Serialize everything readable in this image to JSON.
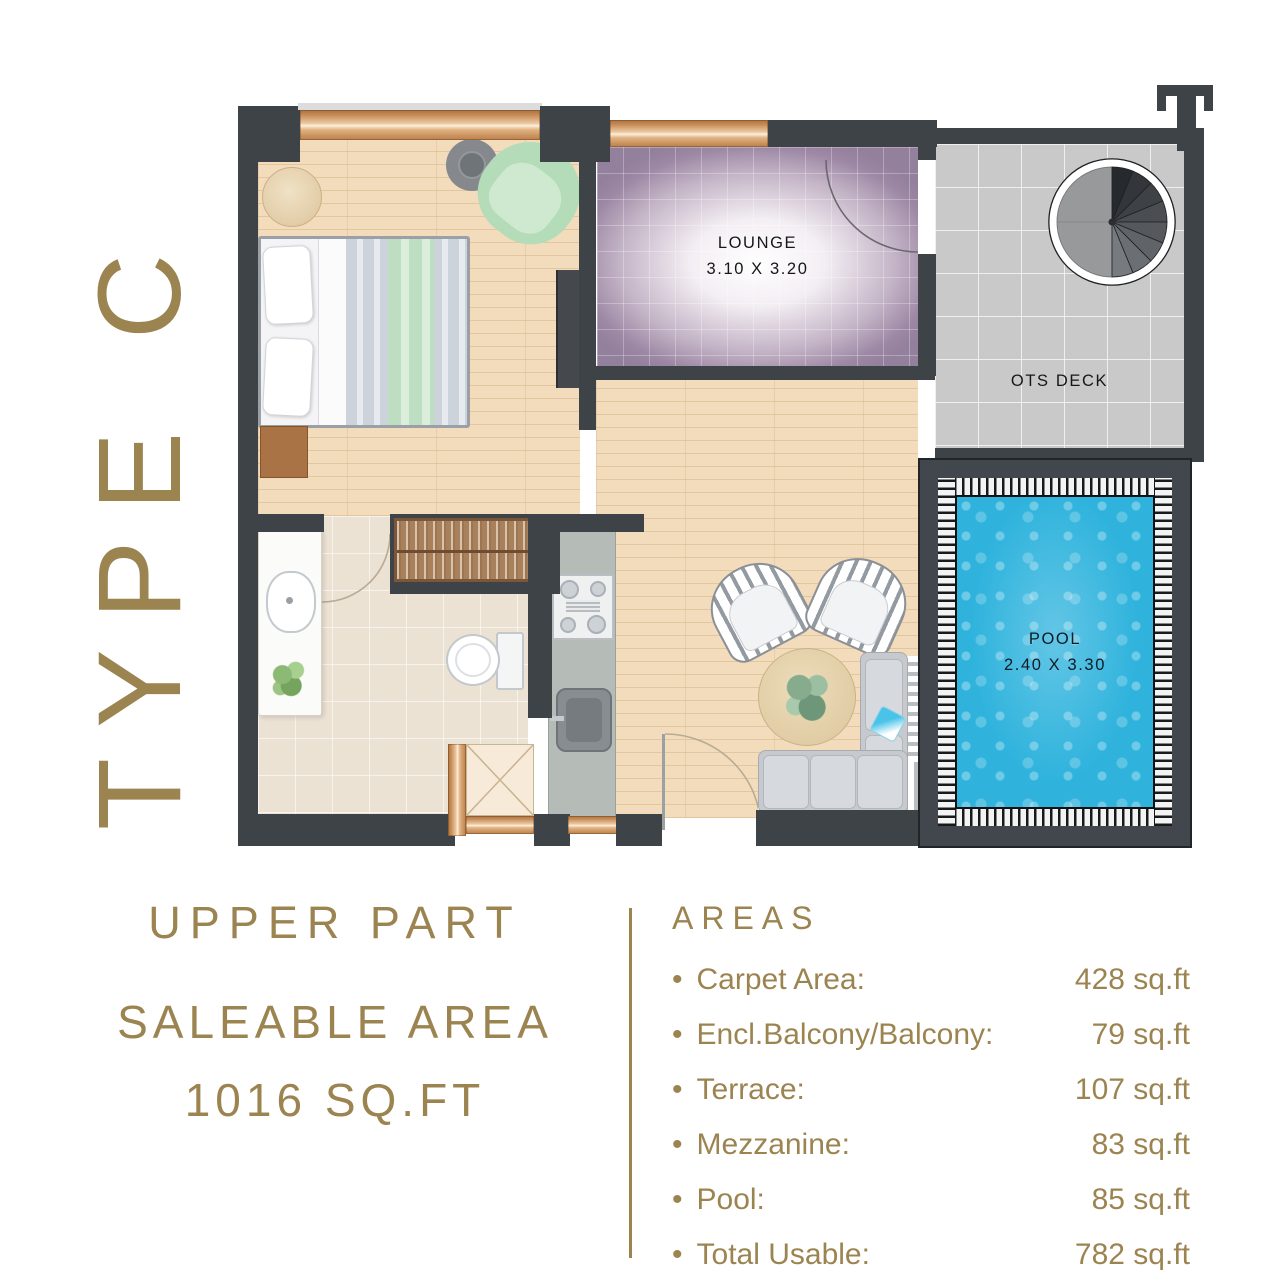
{
  "title": {
    "side_label": "TYPE C"
  },
  "plan": {
    "lounge": {
      "name": "LOUNGE",
      "dims": "3.10 X 3.20"
    },
    "ots_deck": {
      "name": "OTS DECK"
    },
    "pool": {
      "name": "POOL",
      "dims": "2.40 X 3.30"
    }
  },
  "footer": {
    "part_label": "UPPER PART",
    "saleable_label": "SALEABLE AREA",
    "saleable_value": "1016 SQ.FT",
    "areas": {
      "heading": "AREAS",
      "items": [
        {
          "label": "Carpet Area:",
          "value": "428 sq.ft"
        },
        {
          "label": "Encl.Balcony/Balcony:",
          "value": "79 sq.ft"
        },
        {
          "label": "Terrace:",
          "value": "107 sq.ft"
        },
        {
          "label": "Mezzanine:",
          "value": "83 sq.ft"
        },
        {
          "label": "Pool:",
          "value": "85 sq.ft"
        },
        {
          "label": "Total Usable:",
          "value": "782 sq.ft"
        }
      ]
    }
  },
  "colors": {
    "gold": "#9c8451",
    "wall_dark": "#3e4347",
    "pool_blue": "#2fb3dd",
    "lounge_purple": "#9c87a4",
    "wood": "#f2dcbb",
    "deck_gray": "#c9c9c9",
    "copper": "#c98e58"
  }
}
